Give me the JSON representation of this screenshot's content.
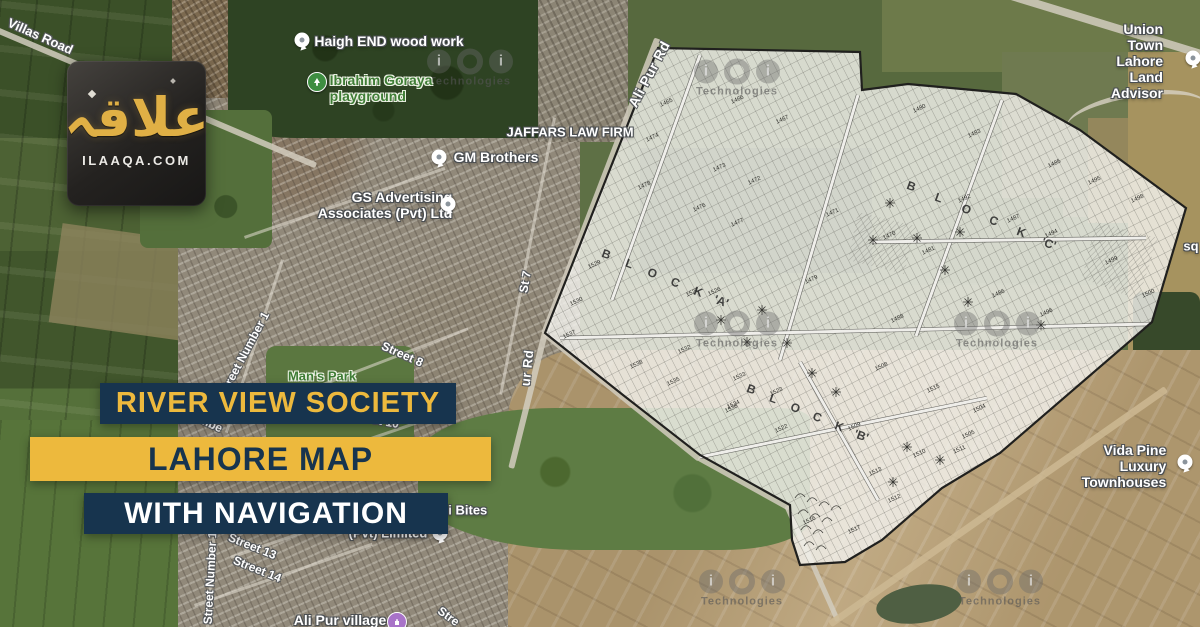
{
  "brand": {
    "logo_arabic": "علاقہ",
    "logo_domain": "ILAAQA.COM"
  },
  "banners": {
    "line1": "RIVER VIEW SOCIETY",
    "line2": "LAHORE MAP",
    "line3": "WITH NAVIGATION"
  },
  "colors": {
    "navy": "#17344e",
    "yellow": "#edb93d",
    "logo_gold": "#e0b045",
    "park_green": "#3f7d36"
  },
  "watermark_text": "Technologies",
  "map_labels": [
    {
      "text": "Villas Road",
      "x": 40,
      "y": 37,
      "rot": 24,
      "cls": "road",
      "size": 13
    },
    {
      "text": "Haigh END wood work",
      "x": 389,
      "y": 41,
      "rot": 0,
      "cls": "poi",
      "size": 14
    },
    {
      "text": "Ibrahim Goraya\nplayground",
      "x": 381,
      "y": 88,
      "rot": 0,
      "cls": "park",
      "size": 14,
      "align": "left"
    },
    {
      "text": "JAFFARS LAW FIRM",
      "x": 570,
      "y": 133,
      "rot": 0,
      "cls": "poi",
      "size": 13
    },
    {
      "text": "GM Brothers",
      "x": 496,
      "y": 157,
      "rot": 0,
      "cls": "poi",
      "size": 14
    },
    {
      "text": "GS Advertising\nAssociates (Pvt) Ltd",
      "x": 385,
      "y": 205,
      "rot": 0,
      "cls": "poi",
      "size": 14,
      "align": "right"
    },
    {
      "text": "Union Town Lahore\nLand Advisor",
      "x": 1126,
      "y": 61,
      "rot": 0,
      "cls": "poi",
      "size": 14,
      "align": "right"
    },
    {
      "text": "Ali Pur Rd",
      "x": 649,
      "y": 74,
      "rot": -62,
      "cls": "road-major",
      "size": 14
    },
    {
      "text": "St 7",
      "x": 526,
      "y": 282,
      "rot": -80,
      "cls": "road",
      "size": 12
    },
    {
      "text": "ur Rd",
      "x": 528,
      "y": 368,
      "rot": -84,
      "cls": "road-major",
      "size": 13
    },
    {
      "text": "Street 8",
      "x": 402,
      "y": 355,
      "rot": 24,
      "cls": "road",
      "size": 12
    },
    {
      "text": "Street Number 1",
      "x": 245,
      "y": 354,
      "rot": -62,
      "cls": "road",
      "size": 12
    },
    {
      "text": "Man's Park",
      "x": 322,
      "y": 377,
      "rot": 0,
      "cls": "park",
      "size": 13
    },
    {
      "text": "umbe",
      "x": 207,
      "y": 423,
      "rot": 25,
      "cls": "road",
      "size": 12
    },
    {
      "text": "eet 10",
      "x": 382,
      "y": 422,
      "rot": 10,
      "cls": "road",
      "size": 12
    },
    {
      "text": "(Pvt) Limited",
      "x": 388,
      "y": 534,
      "rot": 0,
      "cls": "poi",
      "size": 13
    },
    {
      "text": "ini Bites",
      "x": 462,
      "y": 511,
      "rot": 0,
      "cls": "poi",
      "size": 13
    },
    {
      "text": "Street 13",
      "x": 252,
      "y": 547,
      "rot": 22,
      "cls": "road",
      "size": 12
    },
    {
      "text": "Street 14",
      "x": 257,
      "y": 570,
      "rot": 22,
      "cls": "road",
      "size": 12
    },
    {
      "text": "Street Number 1",
      "x": 211,
      "y": 578,
      "rot": -87,
      "cls": "road",
      "size": 12
    },
    {
      "text": "Ali Pur village",
      "x": 340,
      "y": 620,
      "rot": 0,
      "cls": "poi",
      "size": 14
    },
    {
      "text": "Stre",
      "x": 448,
      "y": 617,
      "rot": 36,
      "cls": "road",
      "size": 12
    },
    {
      "text": "sq",
      "x": 1191,
      "y": 247,
      "rot": 0,
      "cls": "poi",
      "size": 13
    },
    {
      "text": "Vida Pine Luxury\nTownhouses",
      "x": 1124,
      "y": 466,
      "rot": 0,
      "cls": "poi",
      "size": 14,
      "align": "right"
    }
  ],
  "pins": [
    {
      "type": "white",
      "x": 302,
      "y": 40,
      "name": "haigh-end-pin"
    },
    {
      "type": "green",
      "x": 317,
      "y": 82,
      "name": "playground-pin"
    },
    {
      "type": "white",
      "x": 439,
      "y": 157,
      "name": "gm-brothers-pin"
    },
    {
      "type": "white",
      "x": 448,
      "y": 204,
      "name": "gs-advertising-pin"
    },
    {
      "type": "white",
      "x": 1193,
      "y": 58,
      "name": "union-town-pin"
    },
    {
      "type": "white",
      "x": 440,
      "y": 533,
      "name": "pvt-limited-pin"
    },
    {
      "type": "purple",
      "x": 397,
      "y": 622,
      "name": "ali-pur-village-pin"
    },
    {
      "type": "white",
      "x": 1185,
      "y": 462,
      "name": "vida-pine-pin"
    }
  ],
  "watermarks": [
    {
      "x": 470,
      "y": 68
    },
    {
      "x": 737,
      "y": 78
    },
    {
      "x": 737,
      "y": 330
    },
    {
      "x": 997,
      "y": 330
    },
    {
      "x": 742,
      "y": 588
    },
    {
      "x": 1000,
      "y": 588
    }
  ],
  "overlay": {
    "polygon": "658,48 860,52 862,90 908,84 1016,94 1080,130 1186,208 1152,322 1000,453 942,488 882,540 845,562 800,565 792,540 790,505 700,455 623,395 545,333",
    "hatches": [
      "858,212 916,226 904,274 848,260",
      "1096,222 1158,238 1138,300 1082,278"
    ],
    "streets": [
      "M700,55 L612,300",
      "M858,95 L780,360",
      "M560,338 L1150,324",
      "M1002,100 L916,336",
      "M872,242 L1146,238",
      "M700,457 L987,398",
      "M800,362 L878,500"
    ],
    "scallops": "M795,498 q5,-8 10,-1 M807,502 q5,-8 10,-1 M819,506 q5,-8 10,-1 M831,510 q5,-8 10,-1 M798,514 q5,-8 10,-1 M810,518 q5,-8 10,-1 M822,522 q5,-8 10,-1 M801,530 q5,-8 10,-1 M813,534 q5,-8 10,-1 M804,546 q5,-8 10,-1 M816,550 q5,-8 10,-1",
    "blocks": [
      {
        "letters": [
          "B",
          "L",
          "O",
          "C",
          "K",
          "'A'"
        ],
        "x": 605,
        "y": 258,
        "dx": 23,
        "dy": 9.4
      },
      {
        "letters": [
          "B",
          "L",
          "O",
          "C",
          "K",
          "'C'"
        ],
        "x": 910,
        "y": 190,
        "dx": 27.5,
        "dy": 11.5
      },
      {
        "letters": [
          "B",
          "L",
          "O",
          "C",
          "K",
          "'B'"
        ],
        "x": 750,
        "y": 393,
        "dx": 22,
        "dy": 9.3
      }
    ],
    "plots": [
      [
        "1465",
        667,
        104
      ],
      [
        "1466",
        738,
        101
      ],
      [
        "1467",
        783,
        121
      ],
      [
        "1474",
        653,
        139
      ],
      [
        "1473",
        720,
        169
      ],
      [
        "1472",
        755,
        182
      ],
      [
        "1478",
        645,
        187
      ],
      [
        "1476",
        700,
        209
      ],
      [
        "1477",
        738,
        224
      ],
      [
        "1471",
        833,
        214
      ],
      [
        "1479",
        812,
        281
      ],
      [
        "1529",
        595,
        266
      ],
      [
        "1530",
        577,
        303
      ],
      [
        "1537",
        570,
        336
      ],
      [
        "1538",
        637,
        366
      ],
      [
        "1532",
        685,
        351
      ],
      [
        "1535",
        674,
        383
      ],
      [
        "1534",
        734,
        406
      ],
      [
        "1533",
        740,
        378
      ],
      [
        "1526",
        715,
        293
      ],
      [
        "1527",
        693,
        294
      ],
      [
        "1536",
        732,
        410
      ],
      [
        "1480",
        920,
        110
      ],
      [
        "1483",
        975,
        135
      ],
      [
        "1485",
        1055,
        165
      ],
      [
        "1495",
        1095,
        182
      ],
      [
        "1492",
        965,
        200
      ],
      [
        "1487",
        1014,
        220
      ],
      [
        "1494",
        1052,
        235
      ],
      [
        "1498",
        1138,
        200
      ],
      [
        "1499",
        1112,
        262
      ],
      [
        "1500",
        1149,
        295
      ],
      [
        "1470",
        890,
        237
      ],
      [
        "1481",
        929,
        252
      ],
      [
        "1486",
        999,
        295
      ],
      [
        "1496",
        1047,
        314
      ],
      [
        "1488",
        898,
        320
      ],
      [
        "1523",
        777,
        393
      ],
      [
        "1522",
        782,
        430
      ],
      [
        "1508",
        882,
        368
      ],
      [
        "1515",
        934,
        390
      ],
      [
        "1504",
        980,
        410
      ],
      [
        "1505",
        969,
        436
      ],
      [
        "1509",
        855,
        428
      ],
      [
        "1510",
        920,
        455
      ],
      [
        "1511",
        960,
        451
      ],
      [
        "1513",
        876,
        473
      ],
      [
        "1512",
        895,
        500
      ],
      [
        "1517",
        855,
        531
      ],
      [
        "1516",
        810,
        522
      ]
    ],
    "trees": [
      [
        890,
        203
      ],
      [
        873,
        240
      ],
      [
        917,
        238
      ],
      [
        960,
        232
      ],
      [
        945,
        270
      ],
      [
        762,
        310
      ],
      [
        747,
        342
      ],
      [
        787,
        343
      ],
      [
        812,
        373
      ],
      [
        907,
        447
      ],
      [
        940,
        460
      ],
      [
        893,
        482
      ],
      [
        1041,
        325
      ],
      [
        968,
        302
      ],
      [
        836,
        392
      ],
      [
        721,
        320
      ]
    ]
  }
}
